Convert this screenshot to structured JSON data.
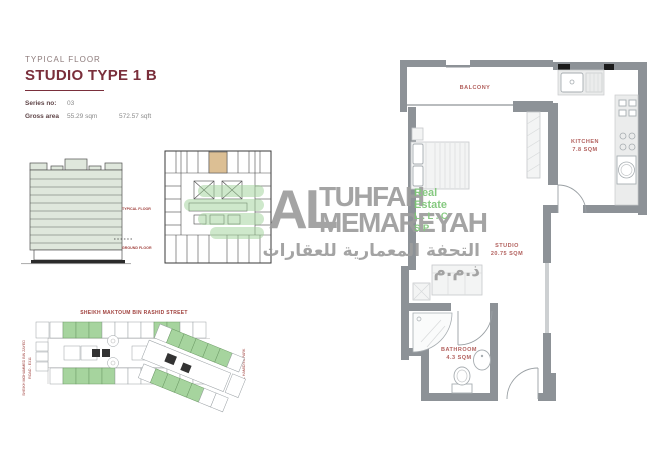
{
  "header": {
    "eyebrow": "TYPICAL FLOOR",
    "title": "STUDIO TYPE 1 B",
    "series_label": "Series no:",
    "series_value": "03",
    "area_label": "Gross area",
    "area_sqm": "55.29 sqm",
    "area_sqft": "572.57 sqft"
  },
  "elevation": {
    "typical_floor": "TYPICAL FLOOR",
    "ground_floor": "GROUND FLOOR"
  },
  "logo": {
    "prefix": "AL",
    "line1": "TUHFAH",
    "line2": "MEMAREYAH",
    "sub1": "Real Estate",
    "sub2": "L.L.C  SP",
    "arabic": "التحفة المعمارية للعقارات ذ.م.م"
  },
  "floor_plan": {
    "balcony": "BALCONY",
    "kitchen": "KITCHEN",
    "kitchen_area": "7.8 SQM",
    "studio": "STUDIO",
    "studio_area": "20.75 SQM",
    "bathroom": "BATHROOM",
    "bathroom_area": "4.3 SQM"
  },
  "site_plan": {
    "street_top": "SHEIKH MAKTOUM BIN RASHID STREET",
    "road_left_1": "SHEIKH MOHAMMED BIN ZAYED",
    "road_left_2": "ROAD - E311",
    "park_right": "AL HAMIDIYA PARK"
  },
  "colors": {
    "accent_maroon": "#7a2f3b",
    "plan_label_red": "#b2605d",
    "logo_gray": "#9d9d9d",
    "logo_green": "#7cc576",
    "wall_gray": "#8d9297",
    "plot_green": "#a6d49e",
    "highlight_tan": "#dcbf94",
    "elevation_fill": "#dfe7dc"
  }
}
